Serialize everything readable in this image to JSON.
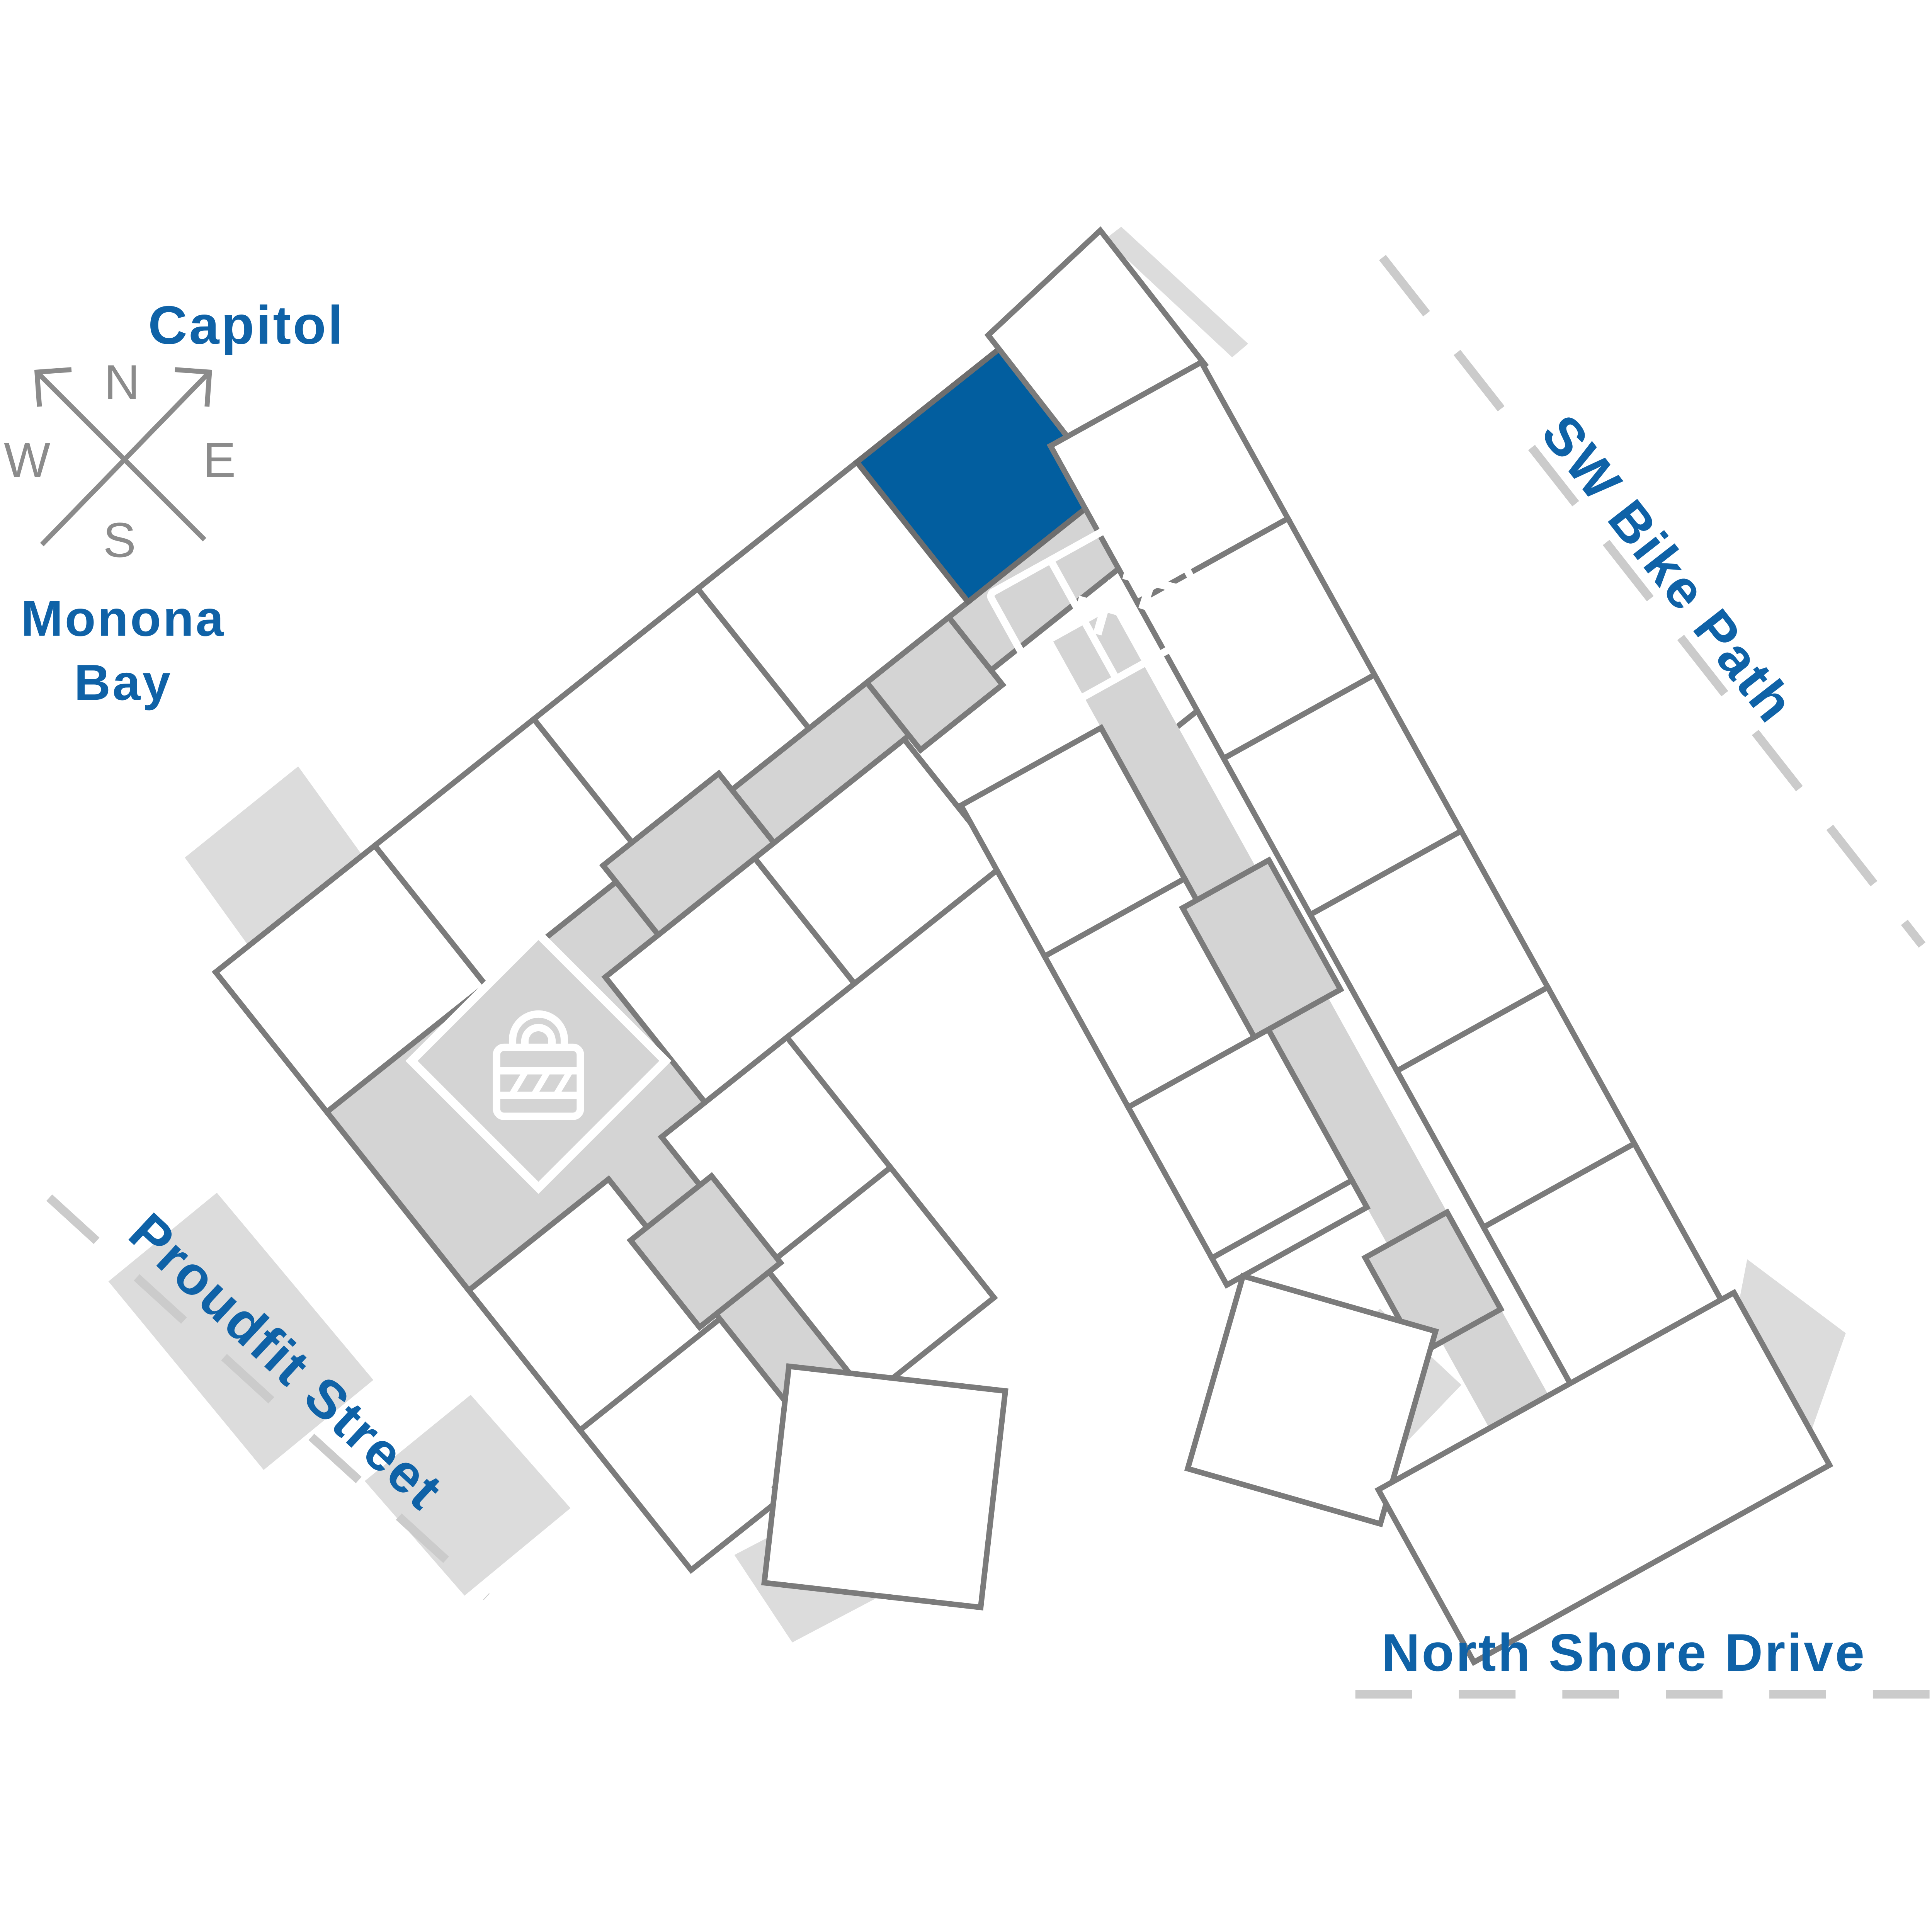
{
  "labels": {
    "capitol": "Capitol",
    "monona_line1": "Monona",
    "monona_line2": "Bay",
    "bike_path": "SW Bike Path",
    "proudfit": "Proudfit Street",
    "north_shore": "North Shore Drive"
  },
  "compass": {
    "n": "N",
    "e": "E",
    "s": "S",
    "w": "W"
  },
  "colors": {
    "accent_text_blue": "#0f62a7",
    "highlighted_unit_blue": "#025E9F",
    "building_outline_gray": "#7b7b7b",
    "corridor_gray": "#d4d4d4",
    "patio_gray": "#dcdcdc",
    "road_dash_gray": "#cbcbcb",
    "compass_gray": "#8b8b8b"
  },
  "icons": {
    "compass": "compass-rose-icon",
    "elevator": "elevator-icon",
    "lock": "lock-icon"
  },
  "map": {
    "highlighted_unit": "selected-unit-near-lobby"
  }
}
